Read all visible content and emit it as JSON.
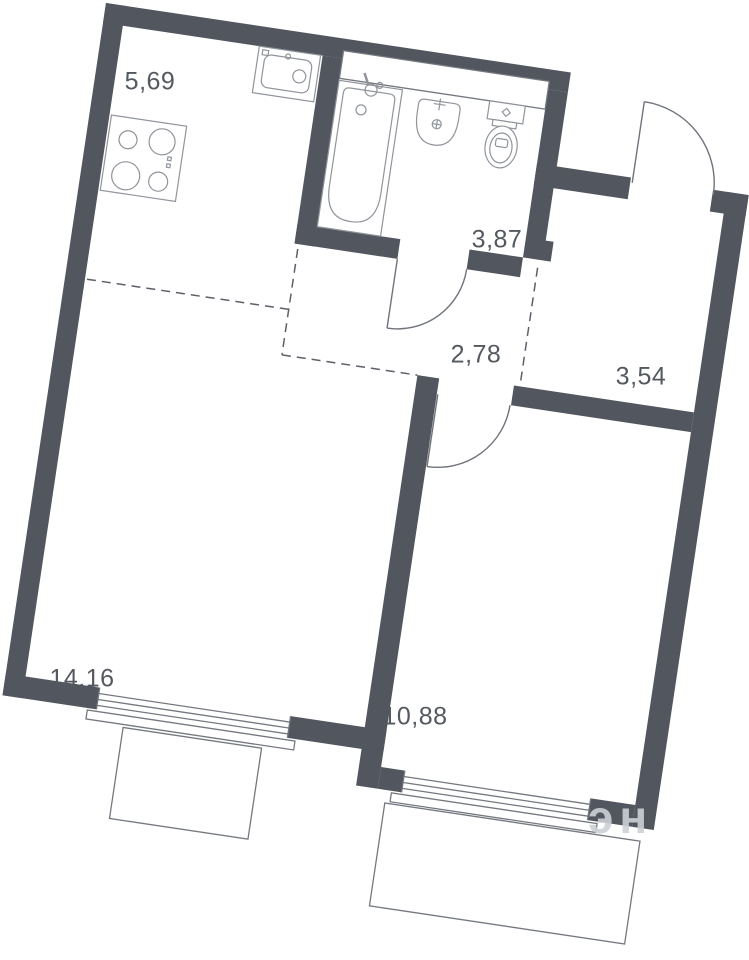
{
  "plan": {
    "type": "apartment-floor-plan",
    "rotation_deg": 8.5,
    "rooms": [
      {
        "id": "kitchen",
        "area": "5,69"
      },
      {
        "id": "bathroom",
        "area": "3,87"
      },
      {
        "id": "hallway",
        "area": "2,78"
      },
      {
        "id": "entry",
        "area": "3,54"
      },
      {
        "id": "living-room",
        "area": "14,16"
      },
      {
        "id": "bedroom",
        "area": "10,88"
      }
    ],
    "fixtures": [
      "stove-icon",
      "kitchen-sink-icon",
      "bathtub-icon",
      "washbasin-icon",
      "toilet-icon"
    ],
    "features": [
      "entrance-door",
      "bathroom-door",
      "bedroom-door",
      "living-room-window",
      "bedroom-window",
      "living-room-balcony",
      "bedroom-balcony",
      "duct-niche",
      "zone-dashed-lines"
    ],
    "colors": {
      "wall": "#51565f",
      "line": "#74787f",
      "fixture": "#90949b",
      "label": "#54585f",
      "background": "#ffffff"
    },
    "watermark": "эн"
  }
}
